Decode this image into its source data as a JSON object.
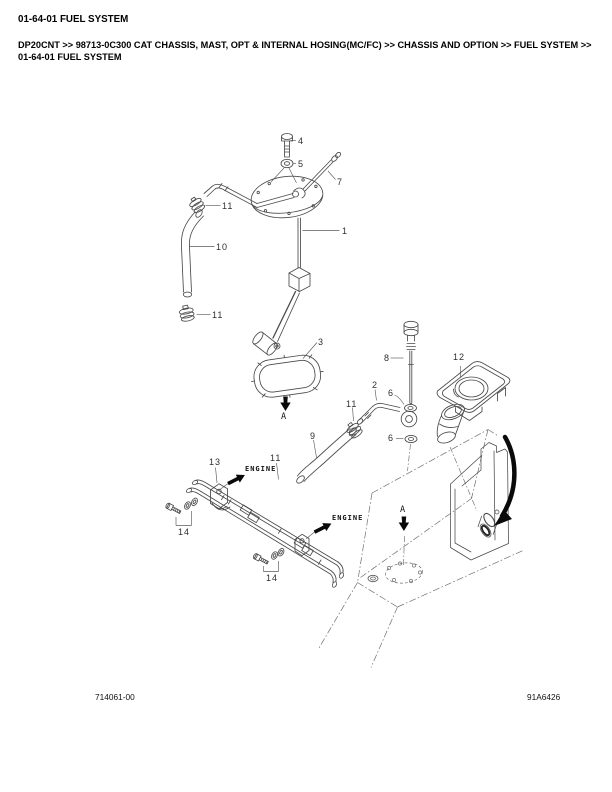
{
  "page": {
    "title": "01-64-01 FUEL SYSTEM",
    "breadcrumb": {
      "lines": [
        "DP20CNT >> 98713-0C300 CAT CHASSIS, MAST, OPT & INTERNAL HOSING(MC/FC) >> CHASSIS AND OPTION >> FUEL SYSTEM >>",
        "01-64-01 FUEL SYSTEM"
      ]
    },
    "footer_left": "714061-00",
    "footer_right": "91A6426"
  },
  "diagram": {
    "description": "Exploded parts drawing of the fuel system: fuel gauge sender unit, gasket, hoses, clamps, fuel lines, brackets and fuel tank shown in phantom lines",
    "labels": [
      {
        "id": "part-4",
        "text": "4"
      },
      {
        "id": "part-5",
        "text": "5"
      },
      {
        "id": "part-7",
        "text": "7"
      },
      {
        "id": "part-1",
        "text": "1"
      },
      {
        "id": "part-11-a",
        "text": "11"
      },
      {
        "id": "part-10",
        "text": "10"
      },
      {
        "id": "part-11-b",
        "text": "11"
      },
      {
        "id": "part-3",
        "text": "3"
      },
      {
        "id": "part-8",
        "text": "8"
      },
      {
        "id": "part-12",
        "text": "12"
      },
      {
        "id": "part-2",
        "text": "2"
      },
      {
        "id": "part-6-a",
        "text": "6"
      },
      {
        "id": "part-11-c",
        "text": "11"
      },
      {
        "id": "part-6-b",
        "text": "6"
      },
      {
        "id": "part-9",
        "text": "9"
      },
      {
        "id": "part-13",
        "text": "13"
      },
      {
        "id": "part-11-d",
        "text": "11"
      },
      {
        "id": "part-14-a",
        "text": "14"
      },
      {
        "id": "part-14-b",
        "text": "14"
      },
      {
        "id": "view-a-upper",
        "text": "A"
      },
      {
        "id": "view-a-lower",
        "text": "A"
      },
      {
        "id": "engine-upper",
        "text": "ENGINE"
      },
      {
        "id": "engine-lower",
        "text": "ENGINE"
      }
    ],
    "colors": {
      "line": "#4a4a4a",
      "phantom": "#6f6f6f",
      "arrow": "#0a0a0a"
    }
  }
}
